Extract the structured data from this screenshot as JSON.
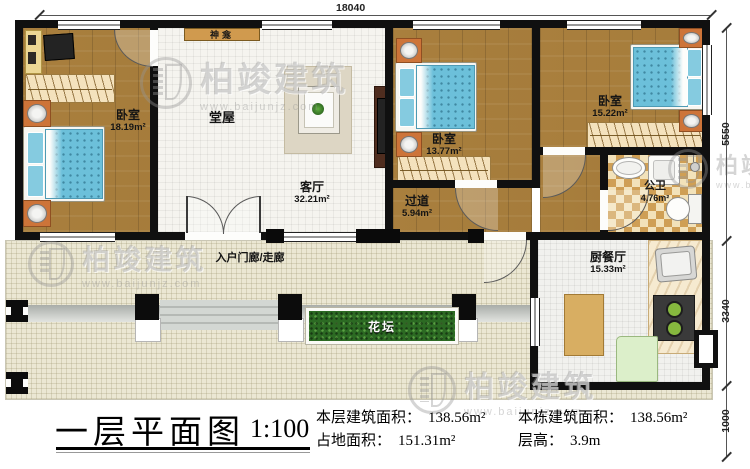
{
  "watermark": {
    "brand": "柏竣建筑",
    "url": "www.baijunjz.com"
  },
  "dimensions": {
    "top": "18040",
    "right_top": "5550",
    "right_mid": "3340",
    "right_bottom": "1000"
  },
  "rooms": {
    "bedroom_left": {
      "name": "卧室",
      "area": "18.19m²"
    },
    "hall": {
      "name": "堂屋"
    },
    "living": {
      "name": "客厅",
      "area": "32.21m²"
    },
    "bedroom_mid": {
      "name": "卧室",
      "area": "13.77m²"
    },
    "bedroom_right": {
      "name": "卧室",
      "area": "15.22m²"
    },
    "bathroom": {
      "name": "公卫",
      "area": "4.76m²"
    },
    "hallway": {
      "name": "过道",
      "area": "5.94m²"
    },
    "kitchen": {
      "name": "厨餐厅",
      "area": "15.33m²"
    },
    "porch": {
      "name": "入户门廊/走廊"
    },
    "flowerbed": {
      "name": "花坛"
    },
    "shrine": {
      "name": "神龛"
    }
  },
  "title_block": {
    "title": "一层平面图",
    "scale": "1:100",
    "stats": [
      {
        "label": "本层建筑面积：",
        "value": "138.56m²"
      },
      {
        "label": "占地面积：",
        "value": "151.31m²"
      },
      {
        "label": "本栋建筑面积：",
        "value": "138.56m²"
      },
      {
        "label": "层高：",
        "value": "3.9m"
      }
    ]
  }
}
